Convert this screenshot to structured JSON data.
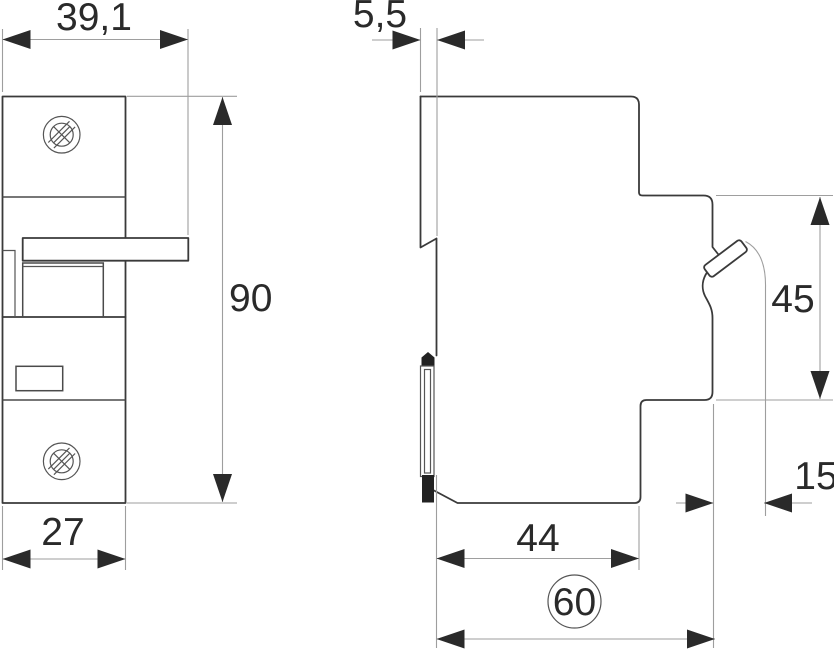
{
  "dims": {
    "front_overall_width": "39,1",
    "front_body_width": "27",
    "height": "90",
    "rear_protrusion": "5,5",
    "upper_section_height": "45",
    "clip_extension": "15",
    "body_depth": "44",
    "overall_depth": "60"
  }
}
